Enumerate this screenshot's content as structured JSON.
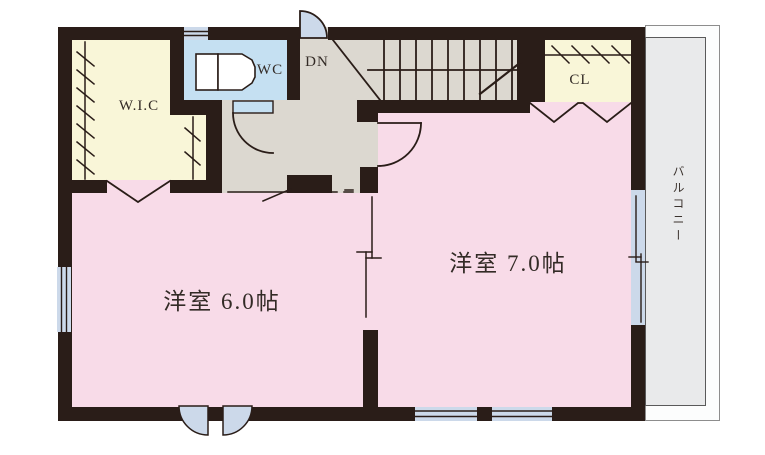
{
  "floor_plan": {
    "labels": {
      "wic": "W.I.C",
      "wc": "WC",
      "dn": "DN",
      "cl": "CL",
      "bedroom6": "洋室 6.0帖",
      "bedroom7": "洋室 7.0帖",
      "balcony": "バルコニー"
    },
    "colors": {
      "wall": "#2a1d18",
      "room_pink": "#f8dbe8",
      "closet_cream": "#f9f6d8",
      "wc_blue": "#c5e0f2",
      "window_blue": "#ccd9ea",
      "hall_gray": "#dcd8d0",
      "balcony_gray": "#e9eaeb"
    }
  }
}
